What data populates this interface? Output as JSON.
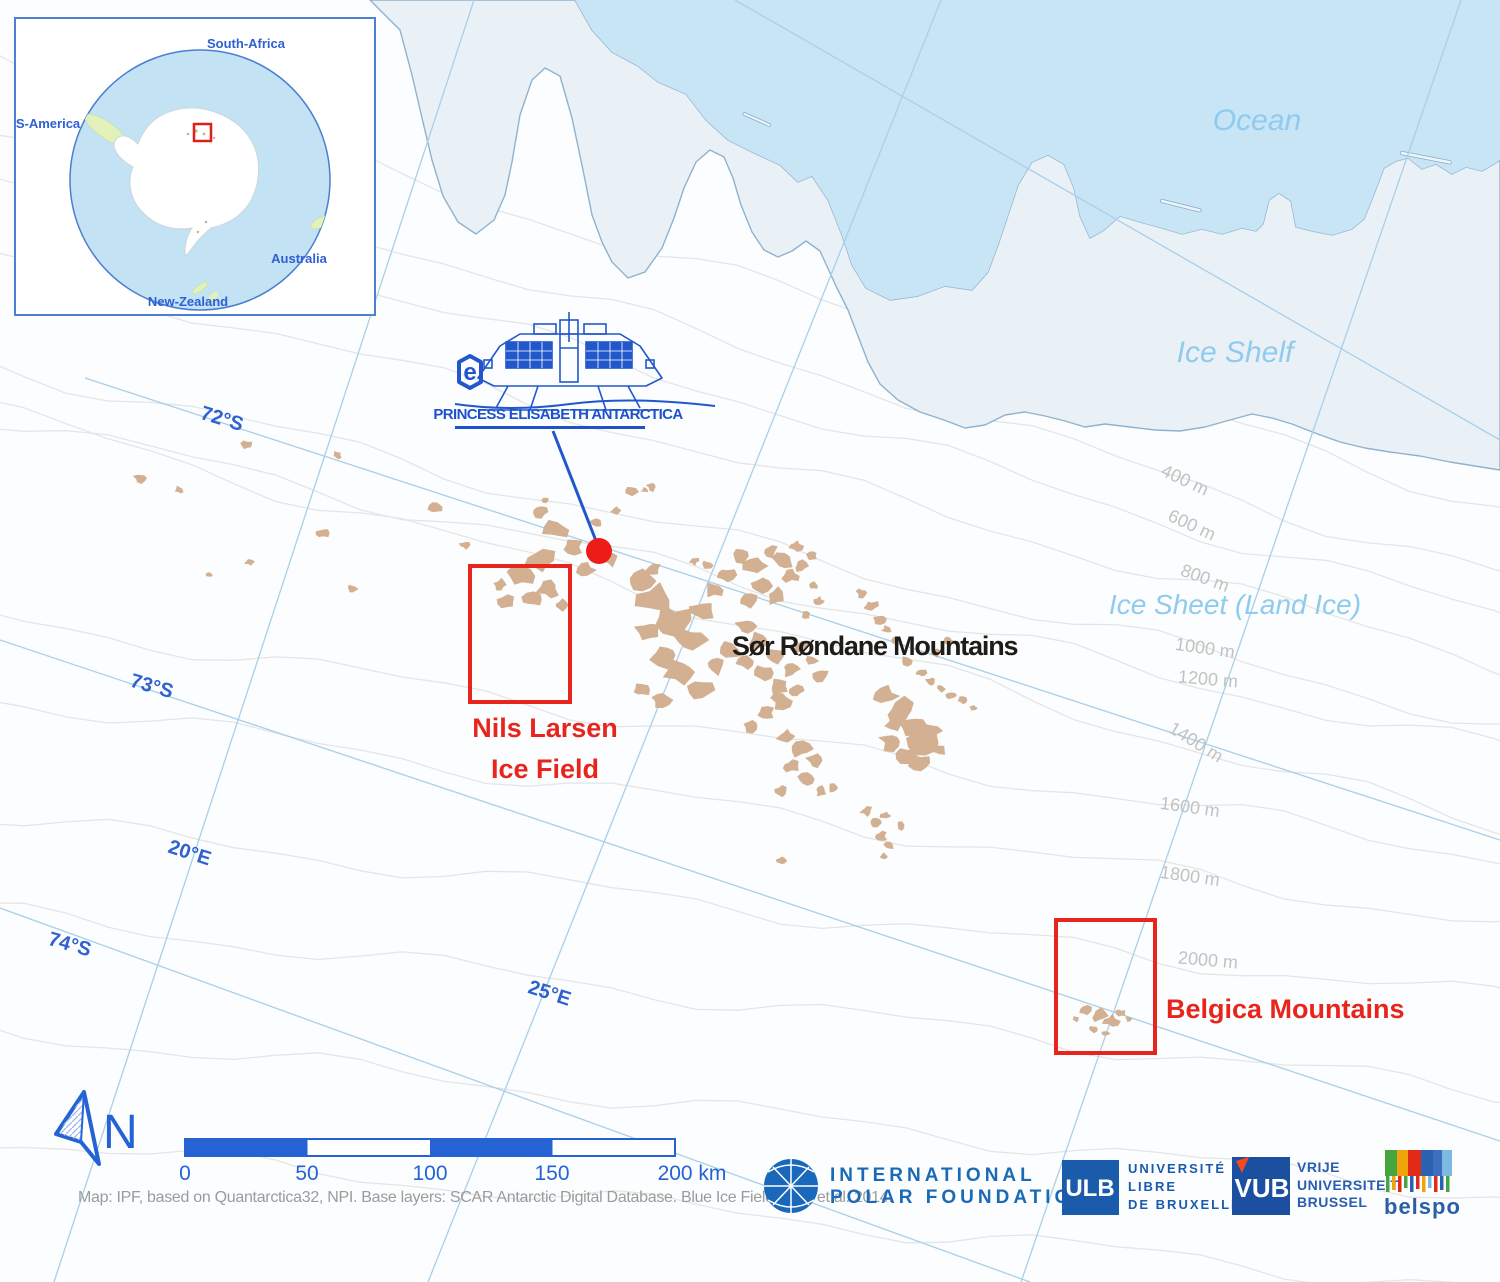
{
  "inset": {
    "labels": {
      "top": "South-Africa",
      "left": "S-America",
      "right": "Australia",
      "bottom": "New-Zealand"
    }
  },
  "map": {
    "areas": {
      "ocean": "Ocean",
      "ice_shelf": "Ice Shelf",
      "ice_sheet": "Ice Sheet (Land Ice)"
    },
    "places": {
      "sor_rondane": "Sør Røndane Mountains",
      "nils_larsen_line1": "Nils Larsen",
      "nils_larsen_line2": "Ice Field",
      "belgica": "Belgica Mountains"
    },
    "station_label": "PRINCESS ELISABETH ANTARCTICA",
    "graticule": {
      "lat_72": "72°S",
      "lat_73": "73°S",
      "lat_74": "74°S",
      "lon_20": "20°E",
      "lon_25": "25°E"
    },
    "contours": {
      "c400": "400 m",
      "c600": "600 m",
      "c800": "800 m",
      "c1000": "1000 m",
      "c1200": "1200 m",
      "c1400": "1400 m",
      "c1600": "1600 m",
      "c1800": "1800 m",
      "c2000": "2000 m"
    }
  },
  "footer": {
    "north": "N",
    "scale": {
      "t0": "0",
      "t50": "50",
      "t100": "100",
      "t150": "150",
      "t200": "200 km"
    },
    "attribution": "Map: IPF, based on Quantarctica32, NPI. Base layers: SCAR Antarctic Digital Database. Blue Ice Fields: Hui et al. 2014.",
    "ipf": {
      "line1": "INTERNATIONAL",
      "line2": "POLAR FOUNDATION"
    },
    "ulb": {
      "mark": "ULB",
      "l1": "UNIVERSITÉ",
      "l2": "LIBRE",
      "l3": "DE BRUXELLES"
    },
    "vub": {
      "mark": "VUB",
      "l1": "VRIJE",
      "l2": "UNIVERSITEIT",
      "l3": "BRUSSEL"
    },
    "belspo": {
      "label": "belspo"
    }
  },
  "colors": {
    "ocean": "#c7e5f5",
    "ice_shelf": "#e9f1f7",
    "coastline": "#7fa6c6",
    "graticule": "#a9cfe9",
    "graticule_label": "#2f62cf",
    "contour": "#e5e5e5",
    "contour_label": "#c2c2c2",
    "mountain": "#d2b091",
    "highlight_red": "#e8251c",
    "station_blue": "#2257cc",
    "scale_blue": "#2563d4",
    "ipf_blue": "#1a6ab5",
    "ulb_blue": "#1b5bab",
    "vub_blue": "#1d4fa0",
    "belspo_blue": "#2a5fa5",
    "region_label": "#8fcbee"
  }
}
